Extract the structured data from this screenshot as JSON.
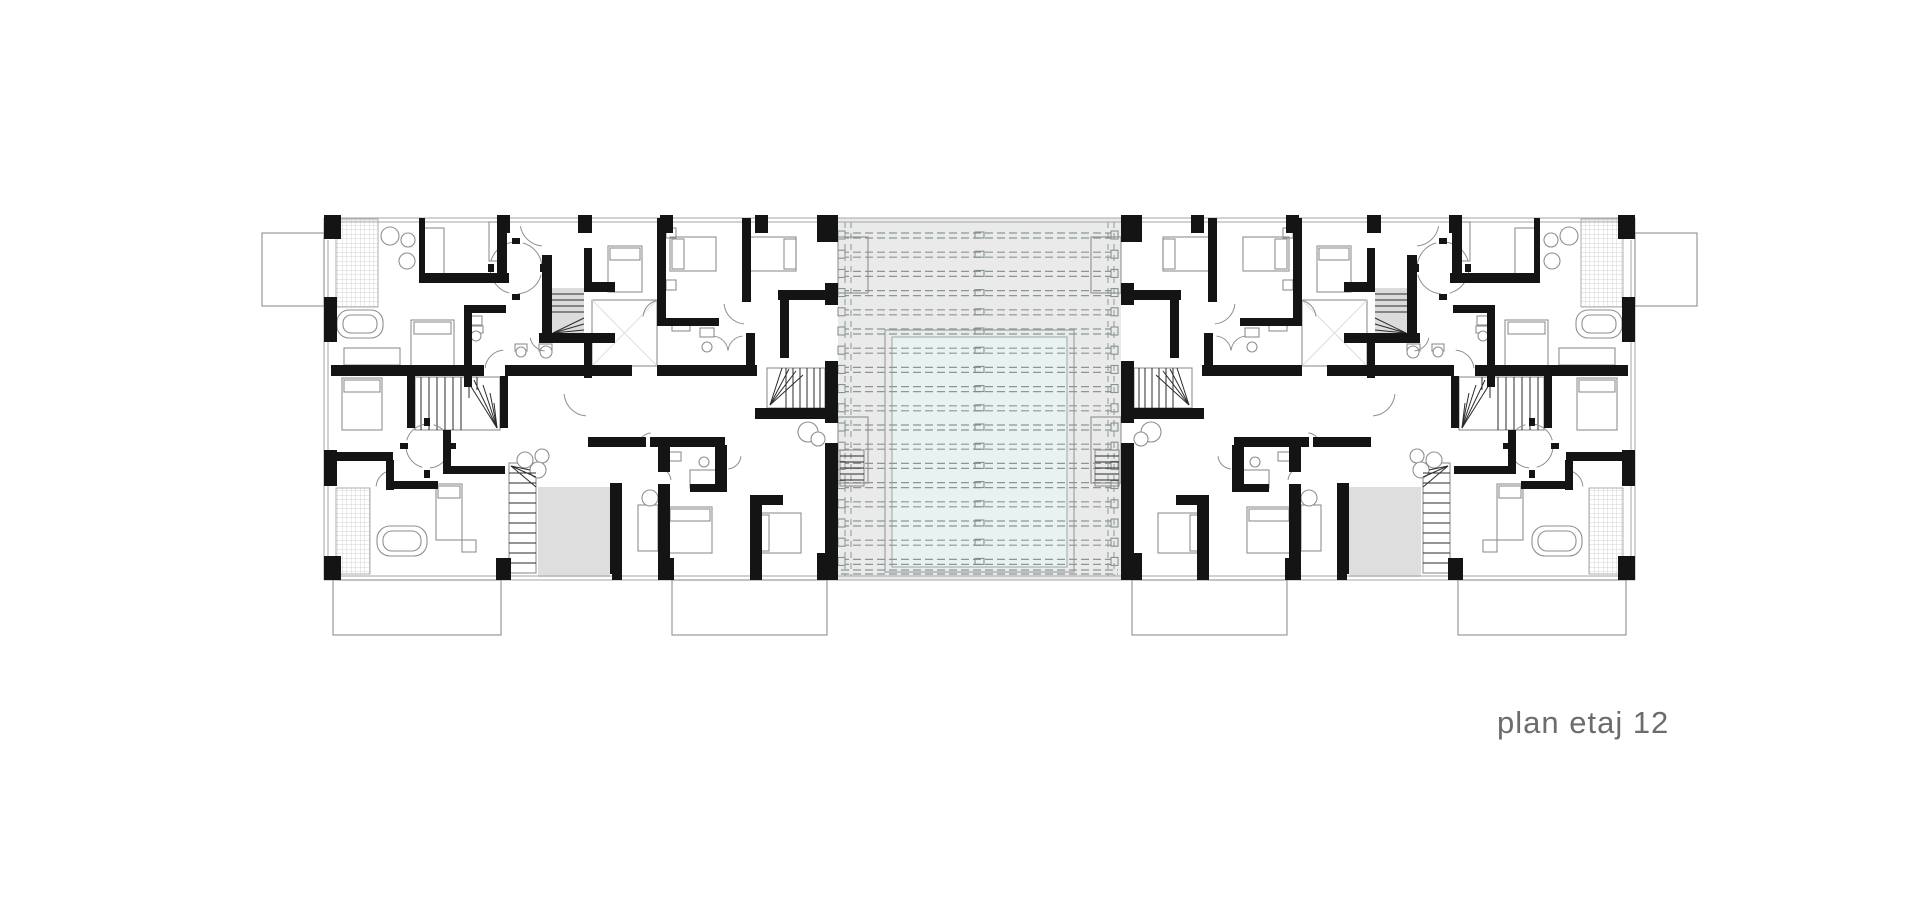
{
  "title": {
    "text": "plan etaj 12",
    "color": "#6c6c6c"
  },
  "colors": {
    "wall": "#141414",
    "thin": "#8f8f8f",
    "outline": "#a6a6a6",
    "dark": "#2b2b2b",
    "light": "#dedede",
    "atrium_bg": "#eaeaea",
    "atrium_line": "#8c9696",
    "pool_fill": "#e8f2f1",
    "pool_line": "#9aa5a5",
    "hatch": "#c9c9c9",
    "terrace": "#dedede",
    "stair_bg": "#dcdcdc",
    "white": "#ffffff"
  },
  "plan": {
    "canvas": {
      "w": 1920,
      "h": 900
    },
    "mirror_axis": 1959,
    "atrium": {
      "bg": [
        838,
        218,
        283,
        362
      ],
      "rows": {
        "count": 18,
        "y0": 233,
        "step": 19.2,
        "x1": 841,
        "x2": 1118
      },
      "row_squares": [
        838,
        1111
      ],
      "center_tick_x": 975,
      "vlines": [
        845,
        851,
        1108,
        1114
      ],
      "vline_y": [
        222,
        576
      ],
      "pool_outer": [
        885,
        330,
        189,
        242
      ],
      "pool_inner": [
        892,
        337,
        175,
        230
      ],
      "edge_lines": [
        [
          838,
          218,
          1121,
          218
        ],
        [
          838,
          222,
          1121,
          222
        ],
        [
          838,
          576,
          1121,
          576
        ],
        [
          838,
          580,
          1121,
          580
        ]
      ],
      "bottom_dashed": [
        [
          841,
          570,
          1118,
          570
        ],
        [
          841,
          574,
          1118,
          574
        ]
      ]
    },
    "wing": {
      "outline": [
        [
          324,
          218,
          838,
          218
        ],
        [
          324,
          222,
          838,
          222
        ],
        [
          324,
          580,
          838,
          580
        ],
        [
          324,
          576,
          838,
          576
        ],
        [
          324,
          218,
          324,
          580
        ],
        [
          328,
          240,
          328,
          556
        ],
        [
          501,
          580,
          501,
          584
        ],
        [
          672,
          580,
          672,
          584
        ]
      ],
      "fills": [
        [
          538,
          487,
          72,
          90,
          "terrace"
        ],
        [
          551,
          288,
          33,
          47,
          "stair_bg"
        ]
      ],
      "hatch": [
        [
          336,
          219,
          42,
          88
        ],
        [
          336,
          488,
          34,
          86
        ]
      ],
      "walls": [
        [
          324,
          215,
          17,
          24
        ],
        [
          497,
          215,
          13,
          18
        ],
        [
          578,
          215,
          14,
          18
        ],
        [
          660,
          215,
          13,
          18
        ],
        [
          755,
          215,
          13,
          18
        ],
        [
          817,
          215,
          21,
          27
        ],
        [
          324,
          297,
          13,
          45
        ],
        [
          324,
          450,
          13,
          36
        ],
        [
          324,
          556,
          17,
          24
        ],
        [
          496,
          558,
          15,
          22
        ],
        [
          658,
          558,
          16,
          22
        ],
        [
          817,
          553,
          21,
          27
        ],
        [
          612,
          545,
          10,
          35
        ],
        [
          750,
          545,
          12,
          35
        ],
        [
          825,
          283,
          13,
          22
        ],
        [
          825,
          361,
          13,
          62
        ],
        [
          825,
          443,
          13,
          104
        ],
        [
          825,
          547,
          13,
          33
        ],
        [
          419,
          218,
          6,
          60
        ],
        [
          419,
          273,
          90,
          10
        ],
        [
          497,
          233,
          10,
          45
        ],
        [
          542,
          255,
          10,
          82
        ],
        [
          539,
          333,
          76,
          10
        ],
        [
          584,
          282,
          31,
          10
        ],
        [
          584,
          248,
          8,
          40
        ],
        [
          584,
          333,
          8,
          45
        ],
        [
          464,
          305,
          8,
          82
        ],
        [
          464,
          305,
          42,
          8
        ],
        [
          657,
          218,
          9,
          102
        ],
        [
          657,
          318,
          62,
          8
        ],
        [
          742,
          218,
          9,
          84
        ],
        [
          746,
          333,
          9,
          35
        ],
        [
          778,
          290,
          56,
          10
        ],
        [
          780,
          300,
          9,
          58
        ],
        [
          331,
          365,
          153,
          11
        ],
        [
          505,
          365,
          127,
          11
        ],
        [
          657,
          365,
          100,
          11
        ],
        [
          755,
          408,
          78,
          11
        ],
        [
          407,
          376,
          8,
          52
        ],
        [
          500,
          376,
          8,
          52
        ],
        [
          331,
          452,
          62,
          9
        ],
        [
          386,
          460,
          8,
          30
        ],
        [
          386,
          481,
          52,
          8
        ],
        [
          443,
          430,
          8,
          44
        ],
        [
          443,
          466,
          62,
          8
        ],
        [
          588,
          437,
          58,
          10
        ],
        [
          650,
          437,
          75,
          10
        ],
        [
          658,
          447,
          12,
          25
        ],
        [
          658,
          484,
          12,
          90
        ],
        [
          715,
          445,
          12,
          47
        ],
        [
          690,
          484,
          37,
          8
        ],
        [
          750,
          495,
          12,
          79
        ],
        [
          750,
          495,
          33,
          10
        ],
        [
          610,
          483,
          12,
          91
        ],
        [
          512,
          238,
          8,
          6
        ],
        [
          540,
          264,
          6,
          8
        ],
        [
          512,
          294,
          8,
          6
        ],
        [
          488,
          264,
          6,
          8
        ],
        [
          424,
          418,
          6,
          8
        ],
        [
          448,
          443,
          8,
          6
        ],
        [
          424,
          470,
          6,
          8
        ],
        [
          400,
          443,
          8,
          6
        ]
      ],
      "thin": [
        [
          489,
          222,
          13,
          39
        ],
        [
          424,
          228,
          20,
          46
        ],
        [
          411,
          320,
          43,
          48
        ],
        [
          414,
          322,
          37,
          12
        ],
        [
          344,
          348,
          56,
          17
        ],
        [
          342,
          378,
          40,
          52
        ],
        [
          344,
          380,
          36,
          12
        ],
        [
          608,
          246,
          34,
          46
        ],
        [
          610,
          248,
          30,
          12
        ],
        [
          666,
          228,
          10,
          10
        ],
        [
          666,
          280,
          10,
          10
        ],
        [
          670,
          237,
          46,
          34
        ],
        [
          672,
          239,
          12,
          30
        ],
        [
          750,
          237,
          46,
          34
        ],
        [
          784,
          239,
          12,
          30
        ],
        [
          469,
          316,
          13,
          9
        ],
        [
          470,
          326,
          13,
          7
        ],
        [
          515,
          344,
          12,
          7
        ],
        [
          539,
          344,
          13,
          7
        ],
        [
          700,
          328,
          14,
          9
        ],
        [
          672,
          322,
          18,
          9
        ],
        [
          592,
          300,
          65,
          66
        ],
        [
          415,
          377,
          85,
          53
        ],
        [
          767,
          368,
          58,
          40
        ],
        [
          509,
          463,
          27,
          110
        ],
        [
          840,
          450,
          24,
          36
        ],
        [
          838,
          237,
          30,
          56
        ],
        [
          838,
          417,
          30,
          66
        ],
        [
          436,
          484,
          26,
          56
        ],
        [
          438,
          486,
          22,
          12
        ],
        [
          462,
          540,
          14,
          12
        ],
        [
          638,
          505,
          20,
          46
        ],
        [
          668,
          507,
          44,
          46
        ],
        [
          670,
          509,
          40,
          12
        ],
        [
          755,
          513,
          46,
          40
        ],
        [
          757,
          515,
          12,
          36
        ],
        [
          668,
          452,
          13,
          9
        ],
        [
          690,
          470,
          26,
          18
        ],
        [
          262,
          233,
          62,
          73
        ],
        [
          333,
          580,
          168,
          55
        ],
        [
          672,
          580,
          155,
          55
        ]
      ],
      "round": [
        [
          337,
          310,
          46,
          28,
          12
        ],
        [
          343,
          315,
          34,
          18,
          8
        ],
        [
          377,
          526,
          50,
          30,
          13
        ],
        [
          383,
          531,
          38,
          20,
          9
        ]
      ],
      "circles": [
        [
          390,
          236,
          9
        ],
        [
          408,
          240,
          7
        ],
        [
          407,
          261,
          8
        ],
        [
          476,
          336,
          5
        ],
        [
          521,
          352,
          5
        ],
        [
          546,
          352,
          6
        ],
        [
          707,
          347,
          5
        ],
        [
          704,
          462,
          5
        ],
        [
          525,
          460,
          8
        ],
        [
          542,
          456,
          7
        ],
        [
          538,
          470,
          8
        ],
        [
          650,
          498,
          8
        ],
        [
          808,
          432,
          10
        ],
        [
          818,
          439,
          7
        ]
      ],
      "lines": [
        [
          551,
          294,
          584,
          294
        ],
        [
          551,
          300,
          584,
          300
        ],
        [
          551,
          306,
          584,
          306
        ],
        [
          551,
          312,
          584,
          312
        ],
        [
          553,
          333,
          584,
          318
        ],
        [
          553,
          333,
          584,
          324
        ],
        [
          553,
          333,
          584,
          330
        ],
        [
          553,
          333,
          576,
          334
        ],
        [
          421,
          377,
          421,
          430
        ],
        [
          429,
          377,
          429,
          430
        ],
        [
          437,
          377,
          437,
          430
        ],
        [
          445,
          377,
          445,
          430
        ],
        [
          453,
          377,
          453,
          430
        ],
        [
          461,
          377,
          461,
          430
        ],
        [
          469,
          377,
          469,
          398
        ],
        [
          477,
          377,
          477,
          390
        ],
        [
          497,
          428,
          465,
          377
        ],
        [
          497,
          428,
          474,
          380
        ],
        [
          497,
          428,
          483,
          385
        ],
        [
          497,
          428,
          490,
          393
        ],
        [
          497,
          428,
          494,
          403
        ],
        [
          786,
          368,
          786,
          408
        ],
        [
          793,
          368,
          793,
          408
        ],
        [
          800,
          368,
          800,
          408
        ],
        [
          807,
          368,
          807,
          408
        ],
        [
          814,
          368,
          814,
          408
        ],
        [
          820,
          368,
          820,
          408
        ],
        [
          770,
          405,
          782,
          368
        ],
        [
          770,
          405,
          789,
          369
        ],
        [
          770,
          405,
          796,
          371
        ],
        [
          770,
          405,
          803,
          375
        ],
        [
          509,
          473,
          536,
          473
        ],
        [
          509,
          483,
          536,
          483
        ],
        [
          509,
          493,
          536,
          493
        ],
        [
          509,
          503,
          536,
          503
        ],
        [
          509,
          513,
          536,
          513
        ],
        [
          509,
          523,
          536,
          523
        ],
        [
          509,
          533,
          536,
          533
        ],
        [
          509,
          543,
          536,
          543
        ],
        [
          509,
          553,
          536,
          553
        ],
        [
          509,
          563,
          536,
          563
        ],
        [
          511,
          466,
          536,
          477
        ],
        [
          511,
          466,
          536,
          487
        ],
        [
          511,
          466,
          530,
          470
        ],
        [
          840,
          456,
          864,
          456
        ],
        [
          840,
          462,
          864,
          462
        ],
        [
          840,
          468,
          864,
          468
        ],
        [
          840,
          474,
          864,
          474
        ],
        [
          840,
          480,
          864,
          480
        ]
      ],
      "light_lines": [
        [
          592,
          300,
          657,
          366
        ],
        [
          657,
          300,
          592,
          366
        ]
      ],
      "arcs": [
        [
          516,
          268,
          26,
          15,
          85
        ],
        [
          516,
          268,
          26,
          105,
          175
        ],
        [
          516,
          268,
          26,
          195,
          265
        ],
        [
          516,
          268,
          26,
          285,
          355
        ],
        [
          428,
          446,
          22,
          15,
          85
        ],
        [
          428,
          446,
          22,
          105,
          175
        ],
        [
          428,
          446,
          22,
          195,
          265
        ],
        [
          428,
          446,
          22,
          285,
          355
        ],
        [
          661,
          318,
          18,
          185,
          265
        ],
        [
          746,
          302,
          22,
          95,
          175
        ],
        [
          712,
          352,
          16,
          275,
          355
        ],
        [
          744,
          352,
          16,
          185,
          265
        ],
        [
          588,
          392,
          24,
          95,
          175
        ],
        [
          505,
          370,
          20,
          185,
          265
        ],
        [
          652,
          447,
          14,
          185,
          265
        ],
        [
          658,
          481,
          13,
          285,
          355
        ],
        [
          546,
          335,
          16,
          95,
          170
        ],
        [
          394,
          488,
          18,
          185,
          265
        ],
        [
          727,
          455,
          14,
          5,
          85
        ],
        [
          544,
          222,
          24,
          95,
          170
        ]
      ]
    },
    "label_pos": {
      "x": 1497,
      "y": 733
    }
  }
}
